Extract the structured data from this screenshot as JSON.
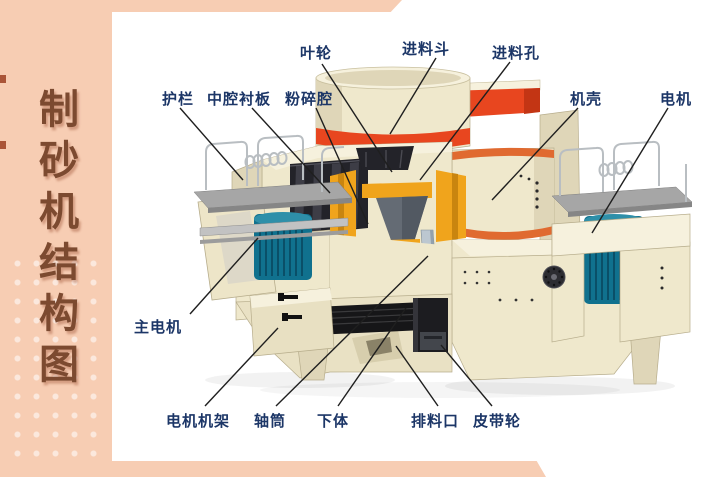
{
  "sidebar": {
    "title": "制砂机结构图"
  },
  "palette": {
    "peach": "#F7CDB3",
    "brown": "#7C4A30",
    "navy": "#1C3667",
    "line": "#1F1F1F",
    "red": "#E8461F",
    "orange": "#E06A30",
    "yellow": "#F0A41C",
    "yellowDark": "#C9850F",
    "cream": "#EFE8CC",
    "creamLight": "#F6F1DD",
    "creamDark": "#DFD6B8",
    "creamShadow": "#C9BF9E",
    "teal": "#10718E",
    "tealDark": "#0A4F68",
    "tealLight": "#2E8FA9",
    "steel": "#BCC7D0",
    "steelDark": "#93A1AD",
    "deck": "#A6A6A6",
    "rail": "#B9BEC2",
    "dark": "#232329",
    "darkSlat": "#3D3D46",
    "black": "#161618",
    "white": "#FFFFFF"
  },
  "diagram": {
    "labels": [
      {
        "id": "impeller",
        "text": "叶轮",
        "cx": 316,
        "top": 42,
        "line": [
          322,
          64,
          392,
          172
        ]
      },
      {
        "id": "feed-hopper",
        "text": "进料斗",
        "cx": 426,
        "top": 38,
        "line": [
          436,
          58,
          390,
          134
        ]
      },
      {
        "id": "feed-hole",
        "text": "进料孔",
        "cx": 516,
        "top": 42,
        "line": [
          510,
          62,
          420,
          180
        ]
      },
      {
        "id": "guardrail",
        "text": "护栏",
        "cx": 178,
        "top": 88,
        "line": [
          180,
          108,
          243,
          180
        ]
      },
      {
        "id": "cavity-liner",
        "text": "中腔衬板",
        "cx": 239,
        "top": 88,
        "line": [
          252,
          108,
          330,
          193
        ]
      },
      {
        "id": "crushing-chamber",
        "text": "粉碎腔",
        "cx": 309,
        "top": 88,
        "line": [
          316,
          108,
          368,
          224
        ]
      },
      {
        "id": "casing",
        "text": "机壳",
        "cx": 586,
        "top": 88,
        "line": [
          578,
          108,
          492,
          200
        ]
      },
      {
        "id": "motor",
        "text": "电机",
        "cx": 676,
        "top": 88,
        "line": [
          668,
          108,
          592,
          233
        ]
      },
      {
        "id": "main-motor",
        "text": "主电机",
        "cx": 158,
        "top": 316,
        "line": [
          190,
          314,
          258,
          238
        ]
      },
      {
        "id": "motor-frame",
        "text": "电机机架",
        "cx": 198,
        "top": 410,
        "line": [
          205,
          406,
          278,
          328
        ]
      },
      {
        "id": "shaft-tube",
        "text": "轴筒",
        "cx": 270,
        "top": 410,
        "line": [
          276,
          406,
          428,
          256
        ]
      },
      {
        "id": "lower-body",
        "text": "下体",
        "cx": 333,
        "top": 410,
        "line": [
          338,
          406,
          406,
          308
        ]
      },
      {
        "id": "discharge-port",
        "text": "排料口",
        "cx": 435,
        "top": 410,
        "line": [
          438,
          406,
          396,
          346
        ]
      },
      {
        "id": "belt-pulley",
        "text": "皮带轮",
        "cx": 497,
        "top": 410,
        "line": [
          492,
          406,
          441,
          345
        ]
      }
    ]
  }
}
